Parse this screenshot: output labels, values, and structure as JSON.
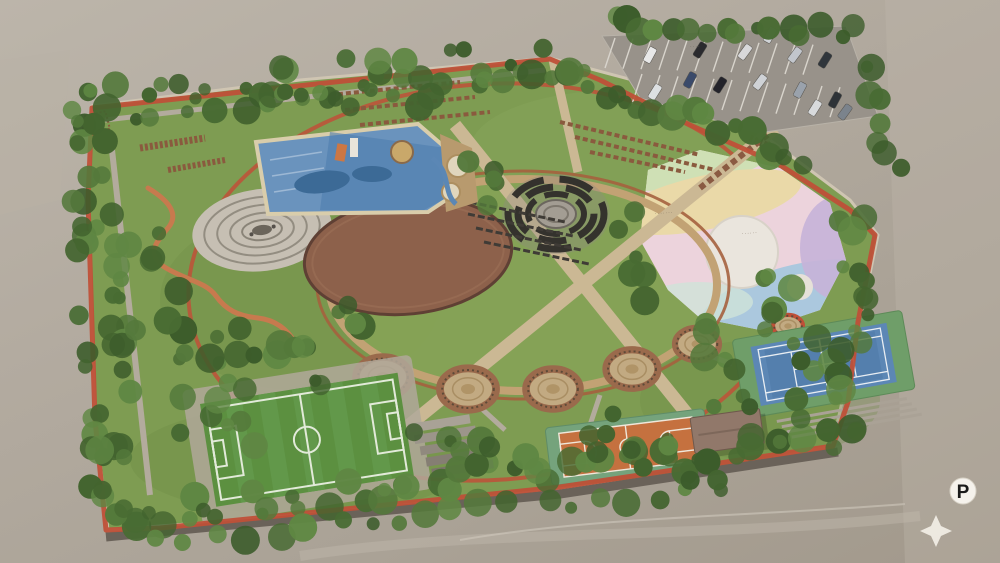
{
  "badges": {
    "parking_symbol": "P"
  },
  "labels": {
    "plaza_label_1": "·······",
    "plaza_label_2": "······",
    "parking_lot_label": "····"
  },
  "facilities": [
    "parking-lot",
    "water-play-pool",
    "spa-pools",
    "spiral-fountain-plaza",
    "dirt-arena",
    "amphitheater",
    "rainbow-plaza",
    "central-lawn-ring",
    "tree-ring-plazas",
    "soccer-field",
    "terraced-seating",
    "basketball-court",
    "tennis-court",
    "pavilion-building",
    "jogging-track",
    "serpentine-path",
    "hedge-rows",
    "tree-belt",
    "compass-star",
    "parking-badge"
  ],
  "colors": {
    "ground": "#b2aa9e",
    "park_grass": "#7e9c52",
    "lawn_inner": "#86a356",
    "track_red": "#bf5038",
    "ring_brick": "#a5603e",
    "ring_tan": "#c2a274",
    "path_tan": "#cbb894",
    "path_gray": "#b3ab9d",
    "pool_blue": "#6a93bd",
    "dirt_field": "#8d614b",
    "soccer_green": "#5c9040",
    "basketball_orange": "#c5713f",
    "tennis_blue": "#5c87b5",
    "court_apron": "#75a37c",
    "tree_green": "#486b33",
    "plaza_pink": "#ecd3dc",
    "roof_brown": "#91786a",
    "parking_asphalt": "#98928a",
    "badge_white": "#f5f2ec"
  }
}
